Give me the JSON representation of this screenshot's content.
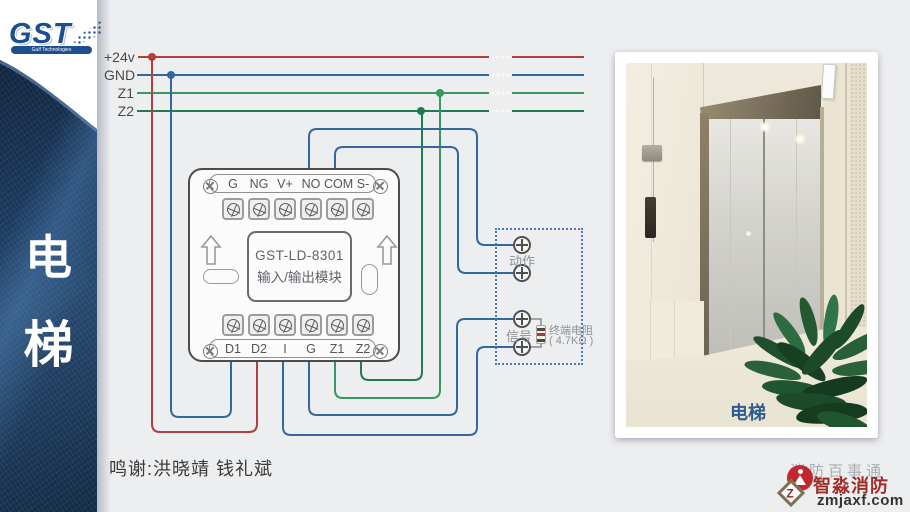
{
  "sidebar": {
    "logo_text": "GST",
    "logo_tagline": "Gulf Technologies",
    "title_char1": "电",
    "title_char2": "梯"
  },
  "bus": {
    "labels": [
      "+24v",
      "GND",
      "Z1",
      "Z2"
    ]
  },
  "module": {
    "model": "GST-LD-8301",
    "subtitle": "输入/输出模块",
    "top_terminals": [
      "G",
      "NG",
      "V+",
      "NO",
      "COM",
      "S-"
    ],
    "bottom_terminals": [
      "D1",
      "D2",
      "I",
      "G",
      "Z1",
      "Z2"
    ]
  },
  "terminal_block": {
    "action_label": "动作",
    "signal_label": "信号",
    "resistor_line1": "终端电阻",
    "resistor_line2": "( 4.7KΩ )"
  },
  "photo": {
    "caption": "电梯"
  },
  "footer": {
    "credits": "鸣谢:洪晓靖 钱礼斌"
  },
  "watermark": {
    "faint_text": "消防百事通",
    "brand": "智淼消防",
    "site": "zmjaxf.com",
    "diamond_glyph": "Z"
  },
  "colors": {
    "bus_24v": "#b0413e",
    "bus_gnd": "#33689e",
    "bus_z1": "#36995f",
    "bus_z2": "#1e7c50",
    "wire_blue": "#33689e",
    "resistor_lead": "#8a8a8a",
    "gap_dot": "#fafafa"
  }
}
